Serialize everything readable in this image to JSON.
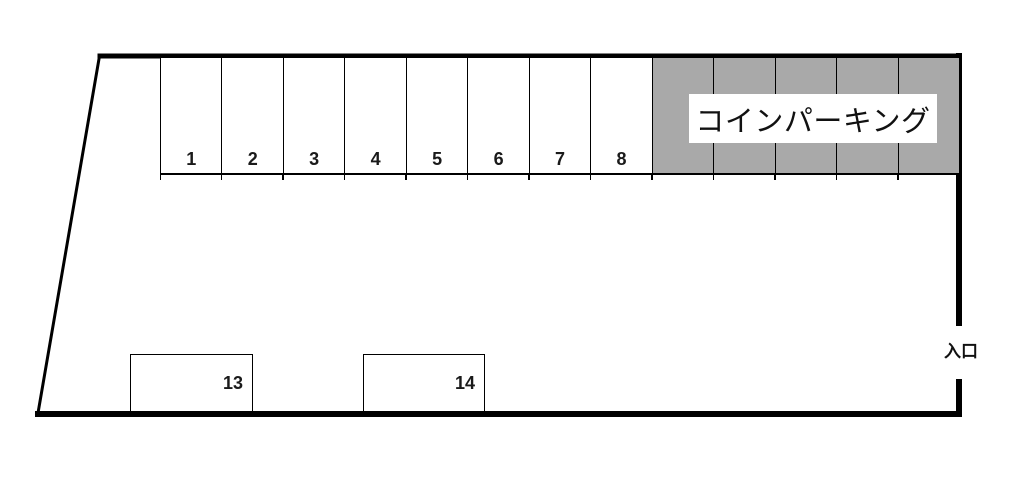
{
  "diagram": {
    "background_color": "#ffffff",
    "line_color": "#000000",
    "top_spaces": [
      "1",
      "2",
      "3",
      "4",
      "5",
      "6",
      "7",
      "8"
    ],
    "coin_parking": {
      "label": "コインパーキング",
      "fill_color": "#a9a9a9",
      "section_count": 5
    },
    "large_spaces": [
      "13",
      "14"
    ],
    "entrance_label": "入口"
  }
}
